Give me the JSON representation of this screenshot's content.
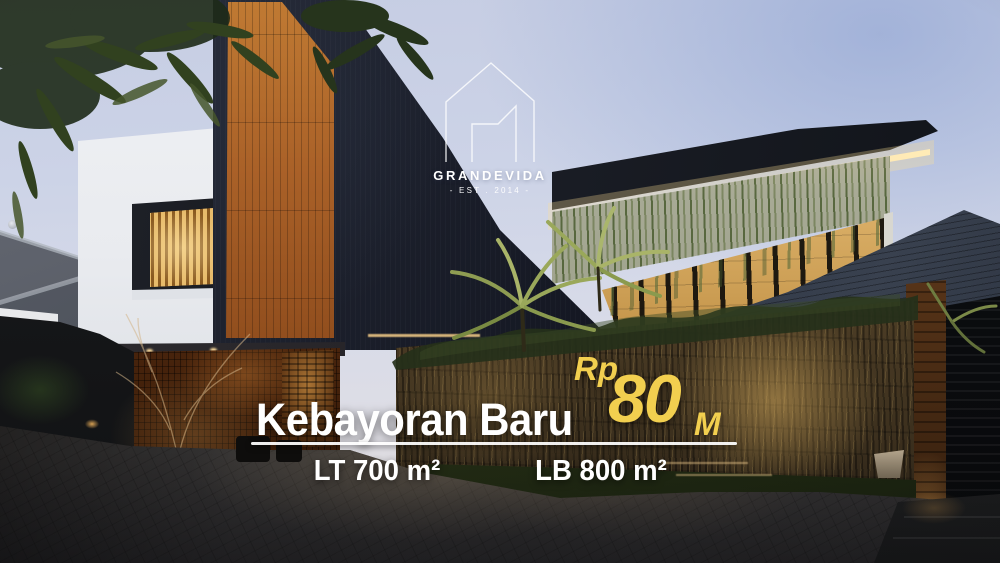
{
  "logo": {
    "brand": "GRANDEVIDA",
    "established": "- EST . 2014 -"
  },
  "listing": {
    "location": "Kebayoran Baru",
    "price": {
      "currency": "Rp",
      "amount": "80",
      "unit": "M"
    },
    "land_area": "LT 700 m²",
    "building_area": "LB 800 m²"
  },
  "colors": {
    "accent_yellow": "#F2CF4F",
    "text_white": "#FFFFFF"
  }
}
